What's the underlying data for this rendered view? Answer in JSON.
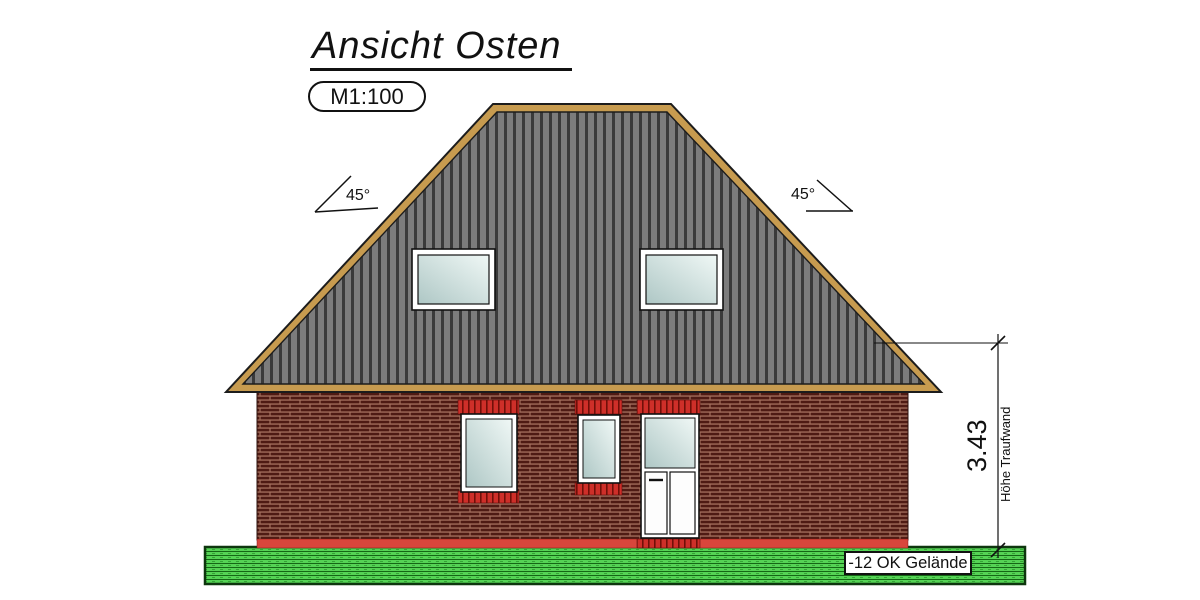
{
  "title_block": {
    "title": "Ansicht Osten",
    "scale": "M1:100"
  },
  "annotations": {
    "left_roof_angle": "45°",
    "right_roof_angle": "45°",
    "eaves_height_value": "3.43",
    "eaves_height_label": "Höhe Traufwand",
    "ground_level_label": "-12 OK Gelände"
  },
  "colors": {
    "line": "#111111",
    "roof_field": "#7c7c7c",
    "roof_stripe": "#3a3a3a",
    "wood_trim": "#c79b4f",
    "brick_mortar": "#a5705e",
    "brick": "#4f1b14",
    "accent_red": "#ce2f29",
    "accent_red_dark": "#701008",
    "base_band_red": "#d8463c",
    "window_frame": "#ffffff",
    "glass_light": "#f0f8f6",
    "glass_dark": "#aec7c5",
    "grass_green": "#55d355",
    "grass_line": "#156615"
  }
}
